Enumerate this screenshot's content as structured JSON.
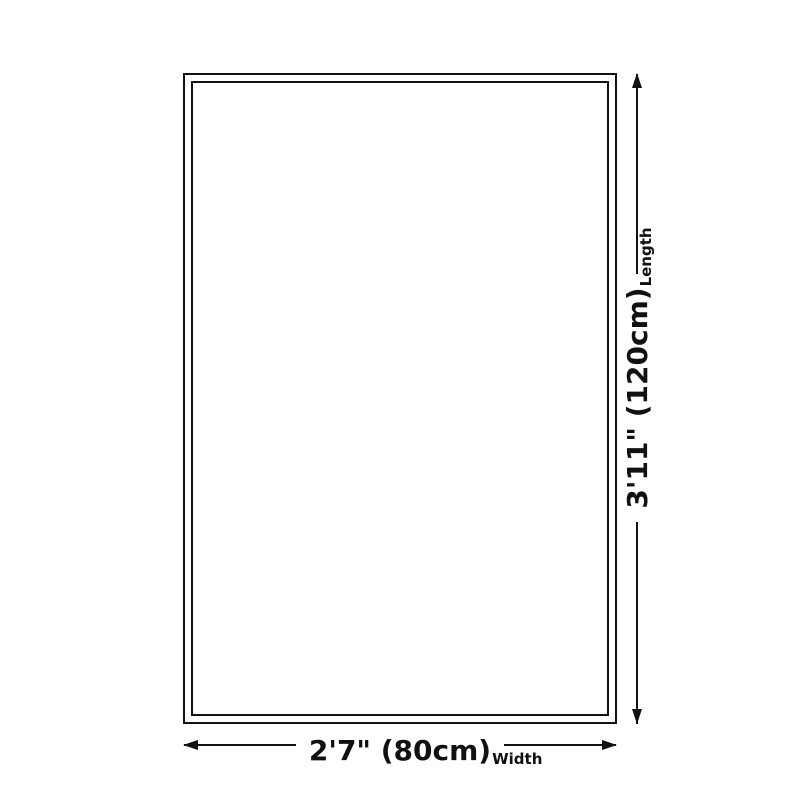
{
  "diagram": {
    "background": "#ffffff",
    "line_color": "#111111",
    "length": {
      "value": "3'11\" (120cm)",
      "axis_label": "Length"
    },
    "width": {
      "value": "2'7\" (80cm)",
      "axis_label": "Width"
    }
  }
}
